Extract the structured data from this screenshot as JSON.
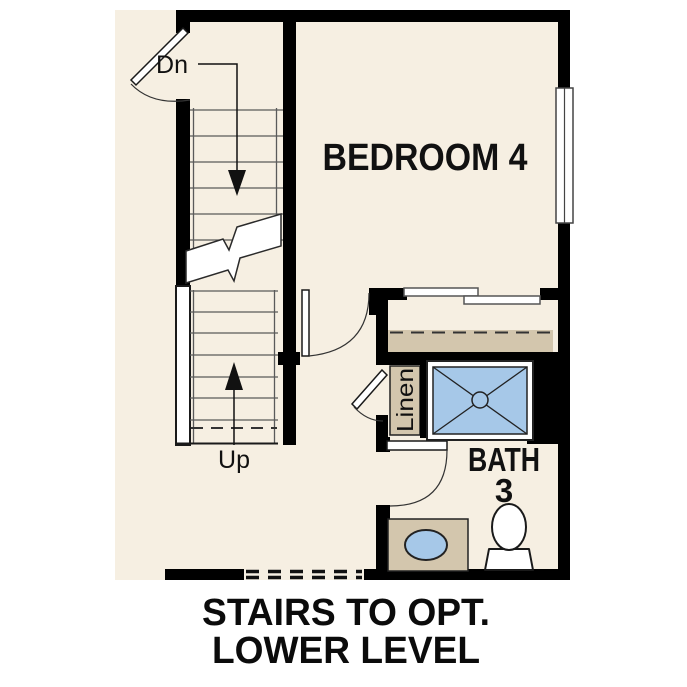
{
  "floor_plan": {
    "labels": {
      "bedroom": "BEDROOM 4",
      "bath": "BATH",
      "bath_number": "3",
      "linen": "Linen",
      "stairs_down": "Dn",
      "stairs_up": "Up"
    },
    "caption": {
      "line1": "STAIRS TO OPT.",
      "line2": "LOWER LEVEL"
    },
    "colors": {
      "floor": "#f6efe2",
      "wall": "#000000",
      "millwork": "#d3c6ad",
      "fixture_blue": "#a6c8e8",
      "stair_line": "#5a5a5a"
    }
  }
}
